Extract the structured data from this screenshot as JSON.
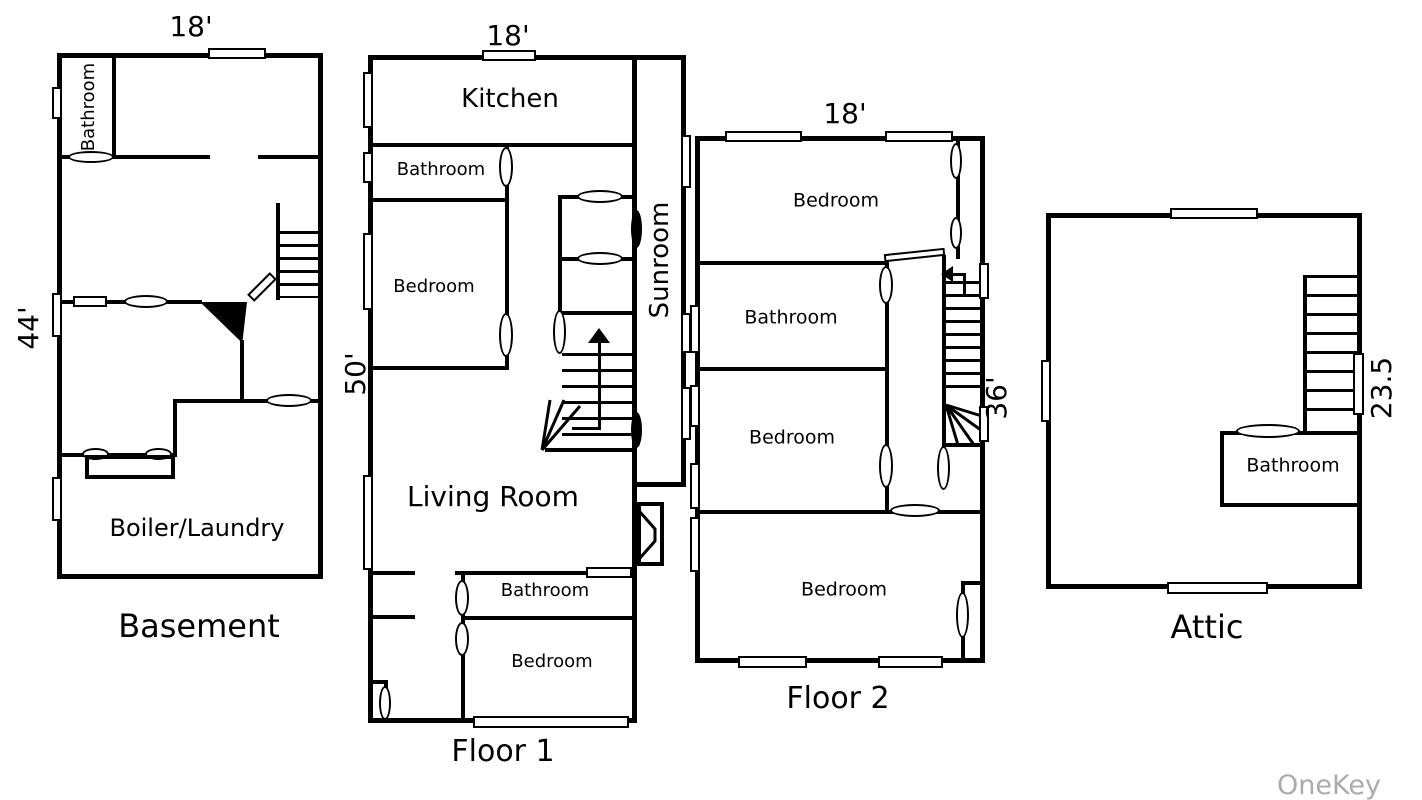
{
  "watermark": "OneKey MLS",
  "colors": {
    "line": "#000000",
    "watermark": "#ababab",
    "background": "#ffffff"
  },
  "plans": {
    "basement": {
      "title": "Basement",
      "dim_top": "18'",
      "dim_left": "44'",
      "rooms": {
        "bathroom": "Bathroom",
        "boiler": "Boiler/Laundry"
      }
    },
    "floor1": {
      "title": "Floor 1",
      "dim_top": "18'",
      "dim_left": "50'",
      "rooms": {
        "kitchen": "Kitchen",
        "bathroom_upper": "Bathroom",
        "bedroom_upper": "Bedroom",
        "sunroom": "Sunroom",
        "living_room": "Living Room",
        "bathroom_lower": "Bathroom",
        "bedroom_lower": "Bedroom"
      }
    },
    "floor2": {
      "title": "Floor 2",
      "dim_top": "18'",
      "dim_right": "36'",
      "rooms": {
        "bedroom_top": "Bedroom",
        "bathroom": "Bathroom",
        "bedroom_middle": "Bedroom",
        "bedroom_bottom": "Bedroom"
      }
    },
    "attic": {
      "title": "Attic",
      "dim_right": "23.5",
      "rooms": {
        "bathroom": "Bathroom"
      }
    }
  }
}
